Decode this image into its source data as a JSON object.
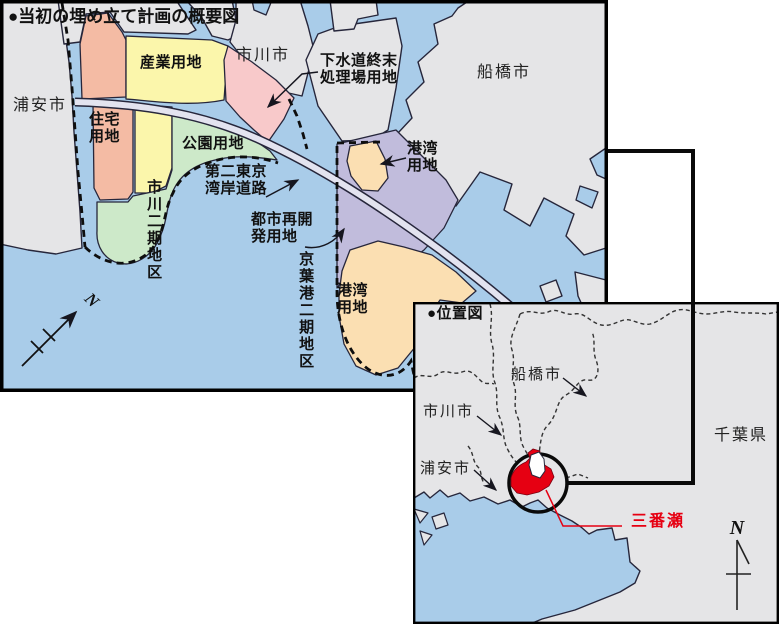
{
  "colors": {
    "water": "#A9CCE9",
    "land_gray": "#E5E5E7",
    "residential_salmon": "#F4BBA4",
    "industrial_yellow": "#FBF6AB",
    "sewage_pink": "#F8C9CA",
    "park_green": "#CDE9C9",
    "urban_purple": "#C1BCDC",
    "port_tan": "#FBDFB2",
    "road_fill": "#E3E3EF",
    "highlight_red": "#E60012",
    "outline_dark": "#26263B"
  },
  "main_map": {
    "title": "●当初の埋め立て計画の概要図",
    "labels": {
      "urayasu_city": "浦安市",
      "ichikawa_city": "市川市",
      "funabashi_city": "船橋市",
      "industrial": "産業用地",
      "residential": "住宅\n用地",
      "park": "公園用地",
      "sewage_plant": "下水道終末\n処理場用地",
      "bayshore_road": "第二東京\n湾岸道路",
      "ichikawa_phase2": "市川二期地区",
      "urban_redevelopment": "都市再開\n発用地",
      "keiyo_port_phase2": "京葉港二期地区",
      "port_upper": "港湾\n用地",
      "port_lower": "港湾\n用地",
      "compass_n": "N"
    }
  },
  "location_map": {
    "title": "●位置図",
    "labels": {
      "funabashi_city": "船橋市",
      "ichikawa_city": "市川市",
      "urayasu_city": "浦安市",
      "chiba_pref": "千葉県",
      "sanbanze": "三番瀬",
      "compass_n": "N"
    }
  }
}
